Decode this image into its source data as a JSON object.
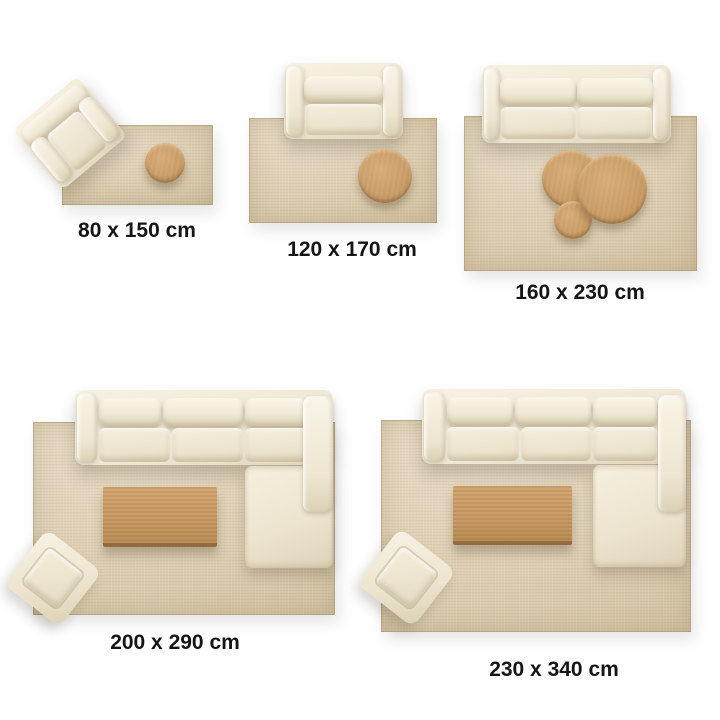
{
  "colors": {
    "background": "#ffffff",
    "rug": "#dbcdb0",
    "upholstery": "#f2ecdb",
    "wood": "#c79a63",
    "label_text": "#151515"
  },
  "panels": [
    {
      "id": "80x150",
      "size_label": "80 x 150 cm",
      "furniture": [
        "armchair",
        "round-side-table"
      ]
    },
    {
      "id": "120x170",
      "size_label": "120 x 170 cm",
      "furniture": [
        "loveseat-sofa",
        "round-coffee-table"
      ]
    },
    {
      "id": "160x230",
      "size_label": "160 x 230 cm",
      "furniture": [
        "two-seat-sofa",
        "nesting-coffee-tables"
      ]
    },
    {
      "id": "200x290",
      "size_label": "200 x 290 cm",
      "furniture": [
        "sectional-sofa",
        "rectangular-coffee-table",
        "ottoman"
      ]
    },
    {
      "id": "230x340",
      "size_label": "230 x 340 cm",
      "furniture": [
        "sectional-sofa",
        "rectangular-coffee-table",
        "ottoman"
      ]
    }
  ]
}
